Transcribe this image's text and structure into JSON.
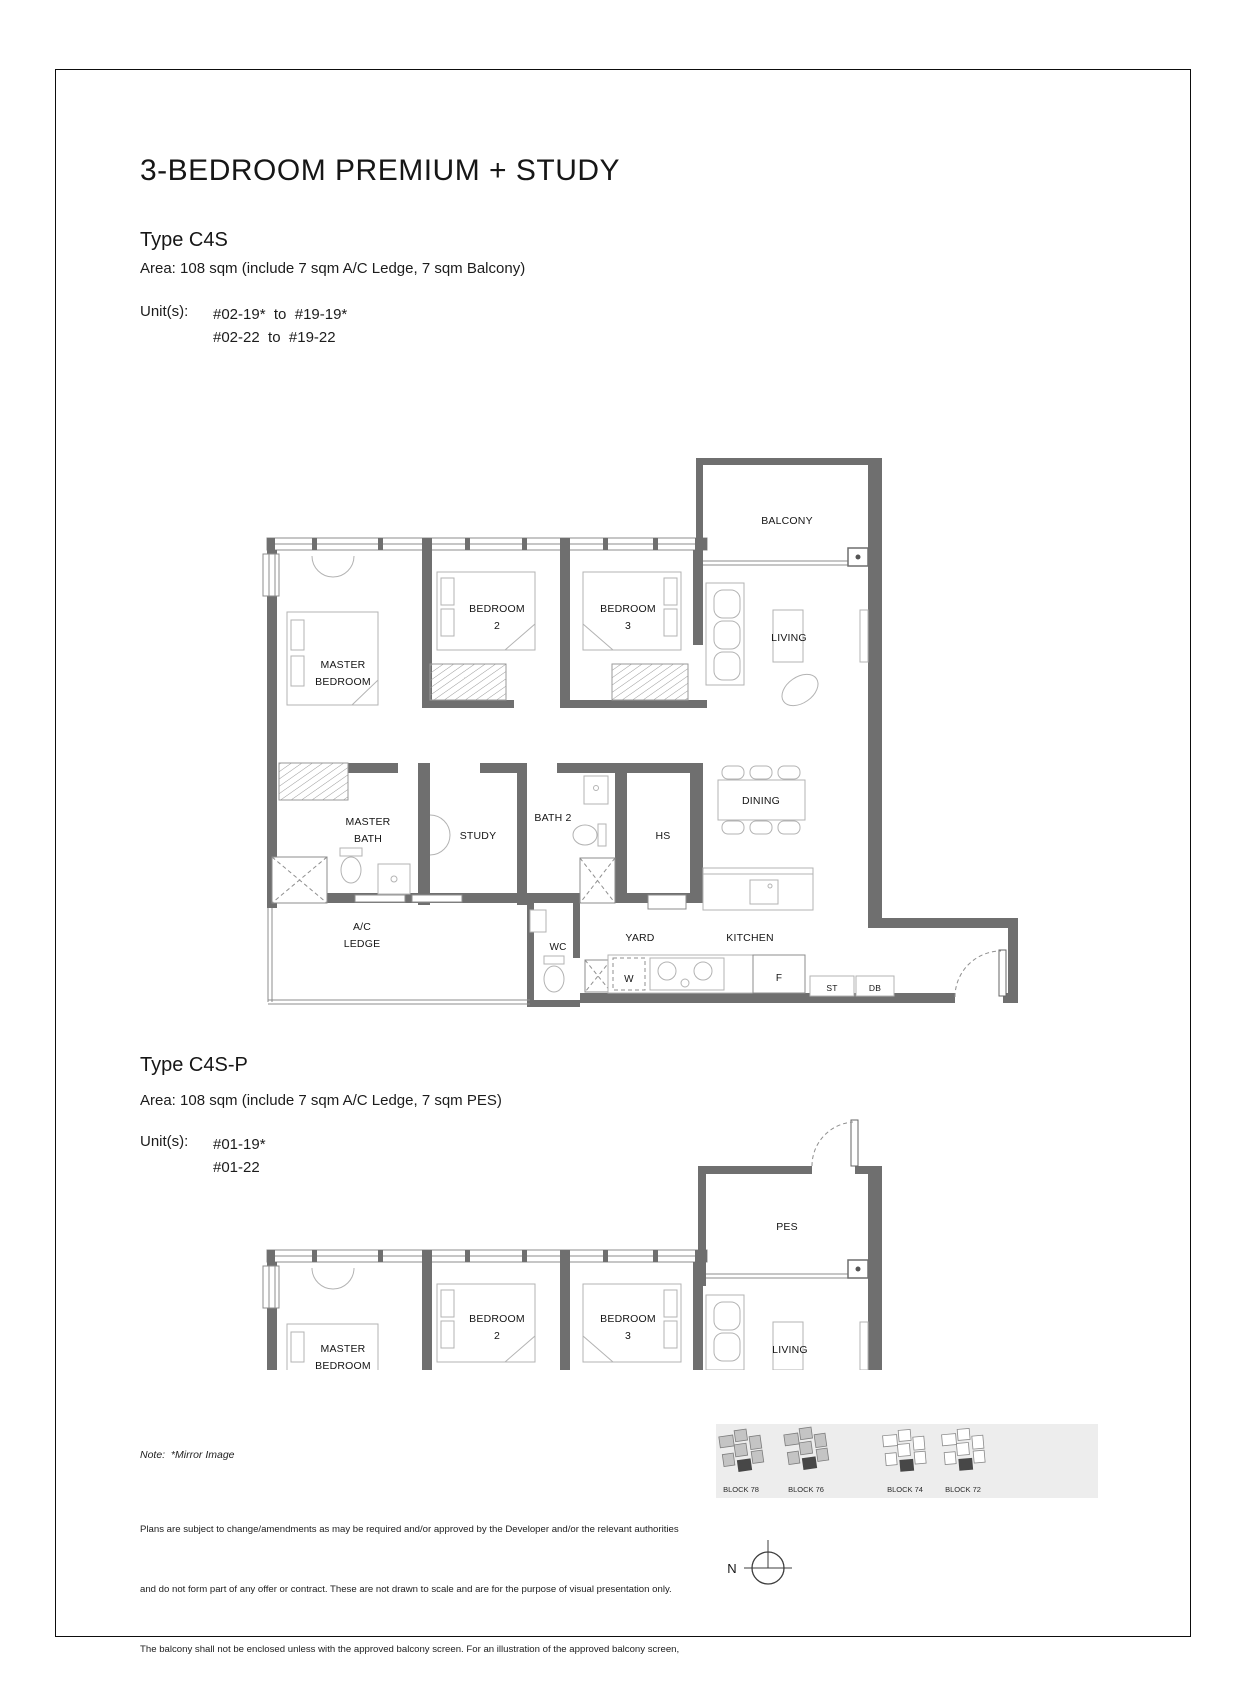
{
  "header": {
    "title": "3-BEDROOM PREMIUM + STUDY"
  },
  "sections": {
    "c4s": {
      "type": "Type C4S",
      "area": "Area: 108 sqm (include 7 sqm A/C Ledge, 7 sqm Balcony)",
      "units_label": "Unit(s):",
      "units": [
        "#02-19*  to  #19-19*",
        "#02-22  to  #19-22"
      ]
    },
    "c4sp": {
      "type": "Type C4S-P",
      "area": "Area: 108 sqm (include 7 sqm A/C Ledge, 7 sqm PES)",
      "units_label": "Unit(s):",
      "units": [
        "#01-19*",
        "#01-22"
      ]
    }
  },
  "plan1": {
    "balcony": "BALCONY",
    "living": "LIVING",
    "dining": "DINING",
    "master_l1": "MASTER",
    "master_l2": "BEDROOM",
    "b2_l1": "BEDROOM",
    "b2_l2": "2",
    "b3_l1": "BEDROOM",
    "b3_l2": "3",
    "mbath_l1": "MASTER",
    "mbath_l2": "BATH",
    "study": "STUDY",
    "bath2": "BATH 2",
    "hs": "HS",
    "wc": "WC",
    "yard": "YARD",
    "kitchen": "KITCHEN",
    "ac_l1": "A/C",
    "ac_l2": "LEDGE",
    "w": "W",
    "f": "F",
    "st": "ST",
    "db": "DB"
  },
  "plan2": {
    "pes": "PES",
    "living": "LIVING",
    "master_l1": "MASTER",
    "master_l2": "BEDROOM",
    "b2_l1": "BEDROOM",
    "b2_l2": "2",
    "b3_l1": "BEDROOM",
    "b3_l2": "3"
  },
  "footer": {
    "note": "Note:  *Mirror Image",
    "disclaimer_lines": [
      "Plans are subject to change/amendments as may be required and/or approved by the Developer and/or the relevant authorities",
      "and do not form part of any offer or contract. These are not drawn to scale and are for the purpose of visual presentation only.",
      "The balcony shall not be enclosed unless with the approved balcony screen. For an illustration of the approved balcony screen,",
      "please refer to APPROVED BALCONY SCREEN DESIGN page of this brochure."
    ]
  },
  "key_plan": {
    "blocks": [
      "BLOCK 78",
      "BLOCK 76",
      "BLOCK 74",
      "BLOCK 72"
    ]
  },
  "compass": {
    "label": "N"
  },
  "colors": {
    "wall": "#6f6f6f",
    "thin_line": "#8c8c8c",
    "furniture": "#b3b3b3",
    "band": "#ededed",
    "text": "#151515"
  }
}
